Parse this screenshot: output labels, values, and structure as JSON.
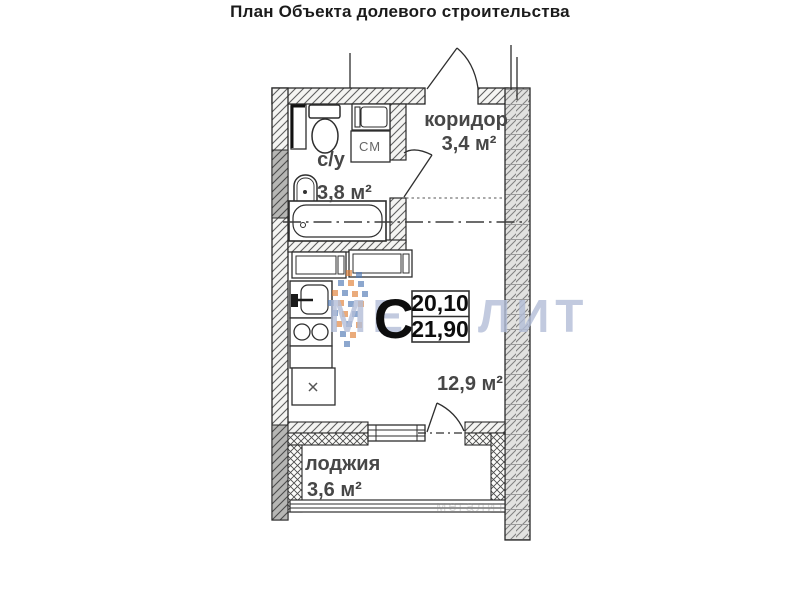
{
  "title": "План Объекта долевого строительства",
  "unit": {
    "letter": "С",
    "area_living": "20,10",
    "area_total": "21,90"
  },
  "rooms": {
    "corridor": {
      "name": "коридор",
      "area": "3,4 м²"
    },
    "bathroom": {
      "name": "с/у",
      "area": "3,8 м²"
    },
    "main_room": {
      "area": "12,9 м²"
    },
    "loggia": {
      "name": "лоджия",
      "area": "3,6 м²"
    }
  },
  "labels": {
    "washing_machine": "СМ"
  },
  "watermark": {
    "text": "МЕГАЛИТ",
    "text_faint": "мегалит",
    "color": "#b3bed8",
    "logo_blue": "#4f79b5",
    "logo_orange": "#e07f35"
  }
}
